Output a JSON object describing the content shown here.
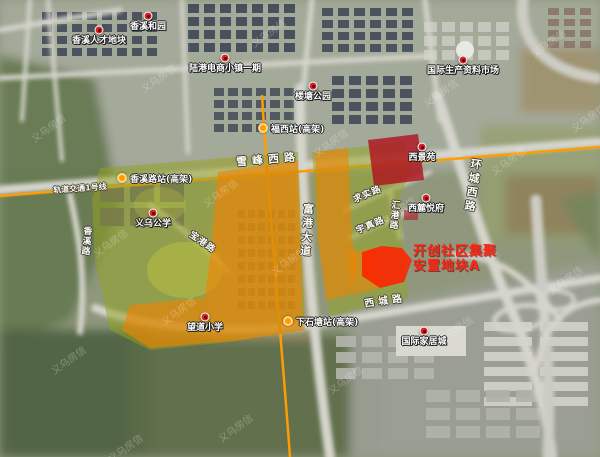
{
  "map": {
    "title_annotation": {
      "line1": "开创社区集聚",
      "line2": "安置地块A"
    },
    "colors": {
      "annotation_red": "#ff2616",
      "zone_green": "#93a41d",
      "zone_orange": "#f08300",
      "zone_dark_red": "#b0101e",
      "plot_red": "#ff2200",
      "metro_orange": "#ff9d00"
    },
    "watermark_text": "义乌房信",
    "pins": [
      {
        "name": "pin-xiangxi-talent-plot",
        "label": "香溪人才地块",
        "x": 99,
        "y": 30
      },
      {
        "name": "pin-xiangxi-heyuan",
        "label": "香溪和园",
        "x": 148,
        "y": 16
      },
      {
        "name": "pin-lugang-ecommerce-town-phase1",
        "label": "陆港电商小镇一期",
        "x": 225,
        "y": 58
      },
      {
        "name": "pin-intl-production-materials-market",
        "label": "国际生产资料市场",
        "x": 463,
        "y": 60
      },
      {
        "name": "pin-loutang-park",
        "label": "楼塘公园",
        "x": 313,
        "y": 86
      },
      {
        "name": "pin-yiwu-public-school",
        "label": "义乌公学",
        "x": 153,
        "y": 213
      },
      {
        "name": "pin-xijing-yuan",
        "label": "西景苑",
        "x": 422,
        "y": 147
      },
      {
        "name": "pin-xilu-yuefu",
        "label": "西麓悦府",
        "x": 426,
        "y": 198
      },
      {
        "name": "pin-wangdao-primary-school",
        "label": "望道小学",
        "x": 205,
        "y": 317
      },
      {
        "name": "pin-intl-furniture-city",
        "label": "国际家居城",
        "x": 424,
        "y": 331
      }
    ],
    "stations": [
      {
        "name": "station-xiangxilu",
        "label": "香溪路站(高架)",
        "x": 122,
        "y": 178
      },
      {
        "name": "station-fuxi",
        "label": "福西站(高架)",
        "x": 263,
        "y": 128
      },
      {
        "name": "station-xiashitang",
        "label": "下石塘站(高架)",
        "x": 288,
        "y": 321
      }
    ],
    "roads": [
      {
        "name": "road-xuefeng-west-label",
        "label": "雪峰西路",
        "x": 268,
        "y": 151,
        "angle": -5,
        "vertical": false,
        "size": 11,
        "spacing": 5
      },
      {
        "name": "road-huancheng-west-label",
        "label": "环城西路",
        "x": 472,
        "y": 158,
        "angle": 8,
        "vertical": true,
        "size": 11,
        "spacing": 3
      },
      {
        "name": "road-fugang-avenue-label",
        "label": "富港大道",
        "x": 306,
        "y": 203,
        "angle": 4,
        "vertical": true,
        "size": 11,
        "spacing": 3
      },
      {
        "name": "road-xicheng-label",
        "label": "西城路",
        "x": 385,
        "y": 292,
        "angle": -8,
        "vertical": false,
        "size": 10,
        "spacing": 4
      },
      {
        "name": "road-qiushi-label",
        "label": "求实路",
        "x": 367,
        "y": 187,
        "angle": -23,
        "vertical": false,
        "size": 9,
        "spacing": 1
      },
      {
        "name": "road-yuzhen-label",
        "label": "宇真路",
        "x": 370,
        "y": 218,
        "angle": -23,
        "vertical": false,
        "size": 9,
        "spacing": 1
      },
      {
        "name": "road-huigang-label",
        "label": "汇港路",
        "x": 394,
        "y": 200,
        "angle": 5,
        "vertical": true,
        "size": 9,
        "spacing": 1
      },
      {
        "name": "road-baogang-label",
        "label": "宝港路",
        "x": 203,
        "y": 235,
        "angle": 35,
        "vertical": false,
        "size": 9,
        "spacing": 1
      },
      {
        "name": "road-xiangxi-label",
        "label": "香溪路",
        "x": 86,
        "y": 226,
        "angle": 5,
        "vertical": true,
        "size": 9,
        "spacing": 1
      },
      {
        "name": "metro-line1-label",
        "label": "轨道交通1号线",
        "x": 80,
        "y": 183,
        "angle": -4,
        "vertical": false,
        "size": 8,
        "spacing": 0
      }
    ],
    "watermarks": [
      {
        "x": 28,
        "y": 120
      },
      {
        "x": 138,
        "y": 70
      },
      {
        "x": 248,
        "y": 25
      },
      {
        "x": 90,
        "y": 235
      },
      {
        "x": 200,
        "y": 185
      },
      {
        "x": 310,
        "y": 135
      },
      {
        "x": 420,
        "y": 85
      },
      {
        "x": 528,
        "y": 35
      },
      {
        "x": 48,
        "y": 352
      },
      {
        "x": 158,
        "y": 303
      },
      {
        "x": 268,
        "y": 253
      },
      {
        "x": 378,
        "y": 203
      },
      {
        "x": 488,
        "y": 153
      },
      {
        "x": 568,
        "y": 110
      },
      {
        "x": 215,
        "y": 420
      },
      {
        "x": 325,
        "y": 372
      },
      {
        "x": 435,
        "y": 322
      },
      {
        "x": 545,
        "y": 272
      },
      {
        "x": 105,
        "y": 440
      }
    ]
  }
}
